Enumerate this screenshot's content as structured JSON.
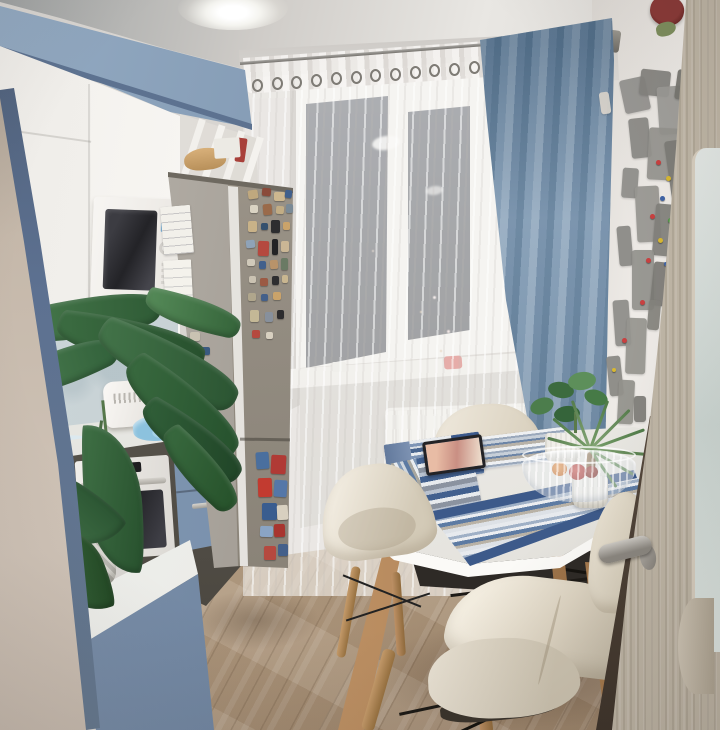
{
  "meta": {
    "description": "Photograph of a small kitchen in the evening: blue-and-white cabinets, built-in white microwave, stainless refrigerator covered in magnets, window with white sheer and blue curtain, white oval dining table with striped blue placemats, cream shell chairs, wooden floor, world-map wall decor and an open wooden door on the right.",
    "width": 720,
    "height": 730
  },
  "labels": {
    "scene": "kitchen at evening",
    "ceiling": "white ceiling with recessed light",
    "upper_cabinets": "blue upper cabinet row",
    "white_cabinets": "white kitchen cabinets",
    "microwave": "built-in white microwave",
    "fridge": "stainless refrigerator with souvenir magnets",
    "backsplash": "glass backsplash panel",
    "counter": "white countertop with kettle and towel",
    "oven": "built-in white oven",
    "plant": "large green houseplant",
    "window": "window with night view",
    "sheer_curtain": "white sheer tulle curtain",
    "blue_curtain": "blue drape curtain",
    "curtain_rod": "metal curtain rod with rings",
    "radiator": "white panel radiator",
    "sill": "white windowsill",
    "table": "white oval dining table with wooden legs",
    "placemats": "blue striped placemats",
    "tablet": "tablet lying on placemat",
    "fruit_bowl": "glass bowl with fruit",
    "chairs": "cream shell chairs",
    "floor": "light oak plank floor",
    "world_map": "gray world map wall decor with pins",
    "door": "open light-wood door with frosted glass",
    "door_handle": "metal door handle",
    "left_wall": "beige side wall"
  },
  "palette": {
    "cabinet_blue": "#7b90ac",
    "cabinet_white": "#f4f2ee",
    "curtain_blue": "#7c97b1",
    "sheer": "#f3f1ee",
    "fridge_steel": "#968f86",
    "wall_beige": "#c9bcae",
    "wall_white": "#e9e6e2",
    "floor_wood": "#c4ae93",
    "table_white": "#f5f4f1",
    "chair_cream": "#e9e3d7",
    "leg_wood": "#c59b6b",
    "mat_navy": "#3d5a8a",
    "door_wood": "#b3aa9c",
    "night_glass": "#30353f",
    "plant_green": "#35643a"
  },
  "fridge_magnets": [
    {
      "x": 248,
      "y": 190,
      "w": 10,
      "h": 9,
      "c": "#bfa87e",
      "r": -8
    },
    {
      "x": 262,
      "y": 188,
      "w": 9,
      "h": 8,
      "c": "#8a4a3a",
      "r": 5
    },
    {
      "x": 274,
      "y": 192,
      "w": 11,
      "h": 9,
      "c": "#cdb78f",
      "r": 0
    },
    {
      "x": 285,
      "y": 190,
      "w": 7,
      "h": 8,
      "c": "#41608c",
      "r": 8
    },
    {
      "x": 250,
      "y": 205,
      "w": 8,
      "h": 8,
      "c": "#dad3c3",
      "r": 0
    },
    {
      "x": 263,
      "y": 204,
      "w": 9,
      "h": 11,
      "c": "#9a6a4a",
      "r": -5
    },
    {
      "x": 276,
      "y": 206,
      "w": 8,
      "h": 8,
      "c": "#c2ad85",
      "r": 4
    },
    {
      "x": 286,
      "y": 204,
      "w": 7,
      "h": 9,
      "c": "#7a8a96",
      "r": 0
    },
    {
      "x": 248,
      "y": 221,
      "w": 9,
      "h": 11,
      "c": "#c9b288",
      "r": 0
    },
    {
      "x": 261,
      "y": 223,
      "w": 7,
      "h": 7,
      "c": "#35506e",
      "r": 0
    },
    {
      "x": 271,
      "y": 220,
      "w": 9,
      "h": 13,
      "c": "#2d2d2f",
      "r": 0
    },
    {
      "x": 283,
      "y": 222,
      "w": 7,
      "h": 8,
      "c": "#caa36a",
      "r": 0
    },
    {
      "x": 246,
      "y": 240,
      "w": 9,
      "h": 8,
      "c": "#8fa3b8",
      "r": -6
    },
    {
      "x": 258,
      "y": 241,
      "w": 11,
      "h": 15,
      "c": "#b5493f",
      "r": 2
    },
    {
      "x": 272,
      "y": 239,
      "w": 6,
      "h": 16,
      "c": "#232325",
      "r": 0
    },
    {
      "x": 281,
      "y": 241,
      "w": 8,
      "h": 11,
      "c": "#cab695",
      "r": 0
    },
    {
      "x": 247,
      "y": 259,
      "w": 8,
      "h": 7,
      "c": "#d0c9ba",
      "r": 0
    },
    {
      "x": 259,
      "y": 261,
      "w": 7,
      "h": 8,
      "c": "#41608c",
      "r": 0
    },
    {
      "x": 270,
      "y": 260,
      "w": 8,
      "h": 9,
      "c": "#b8936a",
      "r": -4
    },
    {
      "x": 281,
      "y": 258,
      "w": 7,
      "h": 12,
      "c": "#6a7a64",
      "r": 0
    },
    {
      "x": 249,
      "y": 276,
      "w": 7,
      "h": 7,
      "c": "#cac2b2",
      "r": 0
    },
    {
      "x": 260,
      "y": 278,
      "w": 8,
      "h": 8,
      "c": "#9b5a44",
      "r": 0
    },
    {
      "x": 272,
      "y": 276,
      "w": 7,
      "h": 9,
      "c": "#2e2e30",
      "r": 0
    },
    {
      "x": 282,
      "y": 275,
      "w": 6,
      "h": 8,
      "c": "#c9b690",
      "r": 0
    },
    {
      "x": 248,
      "y": 293,
      "w": 8,
      "h": 8,
      "c": "#b0a68c",
      "r": 0
    },
    {
      "x": 261,
      "y": 294,
      "w": 7,
      "h": 7,
      "c": "#44608a",
      "r": 0
    },
    {
      "x": 273,
      "y": 292,
      "w": 8,
      "h": 8,
      "c": "#caa36a",
      "r": 0
    },
    {
      "x": 250,
      "y": 310,
      "w": 9,
      "h": 12,
      "c": "#c4b896",
      "r": 0
    },
    {
      "x": 265,
      "y": 312,
      "w": 8,
      "h": 10,
      "c": "#87909c",
      "r": 0
    },
    {
      "x": 277,
      "y": 310,
      "w": 7,
      "h": 9,
      "c": "#2c2c2e",
      "r": 0
    },
    {
      "x": 252,
      "y": 330,
      "w": 8,
      "h": 8,
      "c": "#b5493f",
      "r": 0
    },
    {
      "x": 266,
      "y": 332,
      "w": 7,
      "h": 7,
      "c": "#d8d0c0",
      "r": 0
    },
    {
      "x": 190,
      "y": 332,
      "w": 10,
      "h": 9,
      "c": "#c9c2b2",
      "r": 0
    },
    {
      "x": 201,
      "y": 347,
      "w": 9,
      "h": 8,
      "c": "#3a5a80",
      "r": 0
    },
    {
      "x": 179,
      "y": 351,
      "w": 8,
      "h": 8,
      "c": "#d0cabc",
      "r": 0
    },
    {
      "x": 256,
      "y": 452,
      "w": 13,
      "h": 17,
      "c": "#4a6f9e",
      "r": -4
    },
    {
      "x": 271,
      "y": 455,
      "w": 15,
      "h": 19,
      "c": "#b03a35",
      "r": 3
    },
    {
      "x": 258,
      "y": 478,
      "w": 14,
      "h": 19,
      "c": "#c23b30",
      "r": -2
    },
    {
      "x": 274,
      "y": 480,
      "w": 13,
      "h": 17,
      "c": "#5577a8",
      "r": 4
    },
    {
      "x": 262,
      "y": 503,
      "w": 15,
      "h": 17,
      "c": "#3a5d8f",
      "r": 0
    },
    {
      "x": 277,
      "y": 505,
      "w": 11,
      "h": 15,
      "c": "#d8d0c0",
      "r": -3
    },
    {
      "x": 260,
      "y": 526,
      "w": 13,
      "h": 11,
      "c": "#8aa4c4",
      "r": 2
    },
    {
      "x": 274,
      "y": 524,
      "w": 11,
      "h": 13,
      "c": "#a8352f",
      "r": -2
    },
    {
      "x": 264,
      "y": 546,
      "w": 12,
      "h": 14,
      "c": "#b5493f",
      "r": 0
    },
    {
      "x": 278,
      "y": 544,
      "w": 10,
      "h": 12,
      "c": "#44608a",
      "r": 0
    }
  ],
  "map_pieces": [
    {
      "x": 622,
      "y": 78,
      "w": 26,
      "h": 34,
      "c": "#93928f",
      "r": -12
    },
    {
      "x": 640,
      "y": 70,
      "w": 30,
      "h": 26,
      "c": "#84837f",
      "r": 6
    },
    {
      "x": 658,
      "y": 86,
      "w": 34,
      "h": 48,
      "c": "#9c9b97",
      "r": -4
    },
    {
      "x": 676,
      "y": 70,
      "w": 16,
      "h": 30,
      "c": "#76756f",
      "r": 8
    },
    {
      "x": 630,
      "y": 118,
      "w": 20,
      "h": 40,
      "c": "#8a8985",
      "r": -6
    },
    {
      "x": 648,
      "y": 128,
      "w": 30,
      "h": 52,
      "c": "#95948f",
      "r": 3
    },
    {
      "x": 668,
      "y": 140,
      "w": 22,
      "h": 60,
      "c": "#7d7c77",
      "r": -8
    },
    {
      "x": 622,
      "y": 168,
      "w": 16,
      "h": 30,
      "c": "#8e8d89",
      "r": 4
    },
    {
      "x": 636,
      "y": 186,
      "w": 24,
      "h": 56,
      "c": "#989792",
      "r": -3
    },
    {
      "x": 654,
      "y": 204,
      "w": 20,
      "h": 52,
      "c": "#82817c",
      "r": 5
    },
    {
      "x": 618,
      "y": 226,
      "w": 14,
      "h": 40,
      "c": "#8a8985",
      "r": -5
    },
    {
      "x": 632,
      "y": 250,
      "w": 22,
      "h": 60,
      "c": "#93928d",
      "r": 0
    },
    {
      "x": 652,
      "y": 262,
      "w": 16,
      "h": 44,
      "c": "#7b7a75",
      "r": 6
    },
    {
      "x": 614,
      "y": 300,
      "w": 16,
      "h": 46,
      "c": "#8e8d89",
      "r": -4
    },
    {
      "x": 626,
      "y": 318,
      "w": 20,
      "h": 56,
      "c": "#96958f",
      "r": 2
    },
    {
      "x": 648,
      "y": 300,
      "w": 12,
      "h": 30,
      "c": "#84837d",
      "r": 5
    },
    {
      "x": 608,
      "y": 356,
      "w": 14,
      "h": 40,
      "c": "#8a8984",
      "r": -6
    },
    {
      "x": 618,
      "y": 380,
      "w": 16,
      "h": 44,
      "c": "#93928c",
      "r": 3
    },
    {
      "x": 634,
      "y": 396,
      "w": 12,
      "h": 26,
      "c": "#7e7d78",
      "r": 0
    },
    {
      "x": 600,
      "y": 92,
      "w": 10,
      "h": 22,
      "c": "#d9d4cc",
      "r": -8
    }
  ],
  "map_pins": [
    {
      "x": 656,
      "y": 160,
      "w": 5,
      "h": 5,
      "c": "#c94040"
    },
    {
      "x": 666,
      "y": 176,
      "w": 5,
      "h": 5,
      "c": "#d8b832"
    },
    {
      "x": 660,
      "y": 196,
      "w": 5,
      "h": 5,
      "c": "#3f63a6"
    },
    {
      "x": 650,
      "y": 214,
      "w": 5,
      "h": 5,
      "c": "#c94040"
    },
    {
      "x": 668,
      "y": 218,
      "w": 5,
      "h": 5,
      "c": "#4f9a44"
    },
    {
      "x": 658,
      "y": 238,
      "w": 5,
      "h": 5,
      "c": "#d8b832"
    },
    {
      "x": 646,
      "y": 258,
      "w": 5,
      "h": 5,
      "c": "#c94040"
    },
    {
      "x": 664,
      "y": 262,
      "w": 4,
      "h": 4,
      "c": "#3f63a6"
    },
    {
      "x": 640,
      "y": 300,
      "w": 5,
      "h": 5,
      "c": "#c94040"
    },
    {
      "x": 622,
      "y": 338,
      "w": 5,
      "h": 5,
      "c": "#c94040"
    },
    {
      "x": 612,
      "y": 368,
      "w": 4,
      "h": 4,
      "c": "#d8b832"
    }
  ],
  "rod_rings": [
    {
      "x": 252,
      "y": 79,
      "w": 7,
      "h": 9,
      "c": "transparent"
    },
    {
      "x": 272,
      "y": 77,
      "w": 7,
      "h": 9,
      "c": "transparent"
    },
    {
      "x": 291,
      "y": 76,
      "w": 7,
      "h": 9,
      "c": "transparent"
    },
    {
      "x": 311,
      "y": 74,
      "w": 7,
      "h": 9,
      "c": "transparent"
    },
    {
      "x": 331,
      "y": 72,
      "w": 7,
      "h": 9,
      "c": "transparent"
    },
    {
      "x": 351,
      "y": 71,
      "w": 7,
      "h": 9,
      "c": "transparent"
    },
    {
      "x": 370,
      "y": 69,
      "w": 7,
      "h": 9,
      "c": "transparent"
    },
    {
      "x": 390,
      "y": 68,
      "w": 7,
      "h": 9,
      "c": "transparent"
    },
    {
      "x": 410,
      "y": 66,
      "w": 7,
      "h": 9,
      "c": "transparent"
    },
    {
      "x": 429,
      "y": 64,
      "w": 7,
      "h": 9,
      "c": "transparent"
    },
    {
      "x": 449,
      "y": 63,
      "w": 7,
      "h": 9,
      "c": "transparent"
    },
    {
      "x": 469,
      "y": 61,
      "w": 7,
      "h": 9,
      "c": "transparent"
    },
    {
      "x": 488,
      "y": 59,
      "w": 7,
      "h": 9,
      "c": "transparent"
    },
    {
      "x": 508,
      "y": 58,
      "w": 7,
      "h": 9,
      "c": "transparent"
    },
    {
      "x": 528,
      "y": 56,
      "w": 7,
      "h": 9,
      "c": "transparent"
    },
    {
      "x": 547,
      "y": 54,
      "w": 7,
      "h": 9,
      "c": "transparent"
    },
    {
      "x": 567,
      "y": 53,
      "w": 7,
      "h": 9,
      "c": "transparent"
    },
    {
      "x": 587,
      "y": 51,
      "w": 7,
      "h": 9,
      "c": "transparent"
    }
  ],
  "window_lights": [
    {
      "x": 433,
      "y": 296,
      "w": 3,
      "h": 3,
      "c": "#f3e2e2"
    },
    {
      "x": 447,
      "y": 330,
      "w": 3,
      "h": 3,
      "c": "#eed7d7"
    },
    {
      "x": 420,
      "y": 311,
      "w": 2,
      "h": 2,
      "c": "#d9ba8e"
    },
    {
      "x": 372,
      "y": 250,
      "w": 2,
      "h": 2,
      "c": "#c9b6a6"
    },
    {
      "x": 440,
      "y": 350,
      "w": 2,
      "h": 2,
      "c": "#caa97a"
    }
  ],
  "plant_leaves": [
    {
      "x": 4,
      "y": 296,
      "w": 158,
      "h": 44,
      "r": -14,
      "c": "linear-gradient(100deg,#4a7d4e,#2e5a35)"
    },
    {
      "x": 56,
      "y": 318,
      "w": 150,
      "h": 46,
      "r": 7,
      "c": "linear-gradient(80deg,#3c6d42,#27502d)"
    },
    {
      "x": 0,
      "y": 348,
      "w": 120,
      "h": 40,
      "r": -26,
      "c": "linear-gradient(100deg,#4e8052,#31603a)"
    },
    {
      "x": 92,
      "y": 340,
      "w": 152,
      "h": 50,
      "r": 21,
      "c": "linear-gradient(75deg,#44754a,#2a5331)"
    },
    {
      "x": 114,
      "y": 382,
      "w": 136,
      "h": 52,
      "r": 33,
      "c": "linear-gradient(70deg,#3a6b40,#25502c)"
    },
    {
      "x": 144,
      "y": 296,
      "w": 98,
      "h": 34,
      "r": 12,
      "c": "linear-gradient(90deg,#558a58,#35643a)"
    },
    {
      "x": 134,
      "y": 420,
      "w": 116,
      "h": 42,
      "r": 30,
      "c": "linear-gradient(70deg,#32613a,#1f4326)"
    },
    {
      "x": 84,
      "y": 424,
      "w": 58,
      "h": 150,
      "r": -3,
      "c": "linear-gradient(100deg,#3f7045,#27502d)"
    },
    {
      "x": 30,
      "y": 446,
      "w": 62,
      "h": 124,
      "r": -55,
      "c": "linear-gradient(100deg,#44754a,#2a5331)"
    },
    {
      "x": 150,
      "y": 450,
      "w": 100,
      "h": 38,
      "r": 42,
      "c": "linear-gradient(70deg,#3a6b40,#255029)"
    },
    {
      "x": 50,
      "y": 520,
      "w": 54,
      "h": 96,
      "r": -20,
      "c": "linear-gradient(100deg,#3c6d42,#224723)"
    }
  ]
}
